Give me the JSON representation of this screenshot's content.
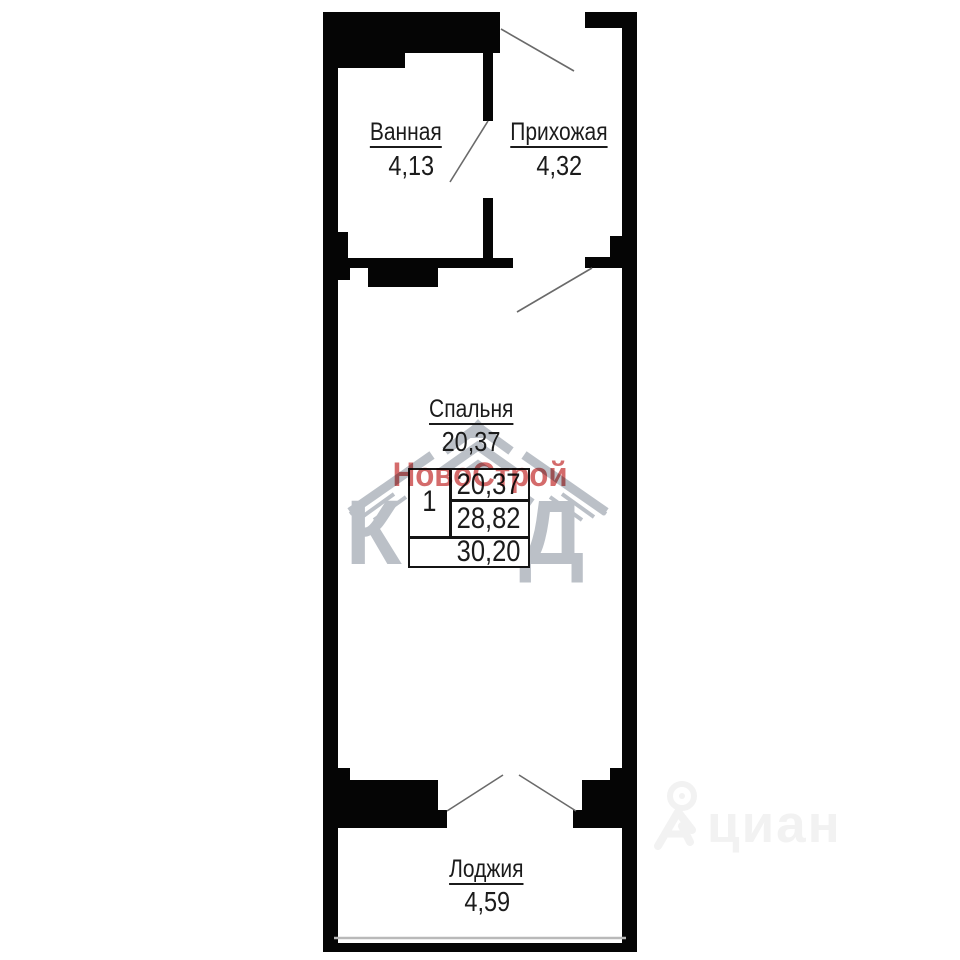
{
  "rooms": {
    "bathroom": {
      "name": "Ванная",
      "area": "4,13"
    },
    "hallway": {
      "name": "Прихожая",
      "area": "4,32"
    },
    "bedroom": {
      "name": "Спальня",
      "area": "20,37"
    },
    "loggia": {
      "name": "Лоджия",
      "area": "4,59"
    }
  },
  "area_table": {
    "rooms_count": "1",
    "living_area": "20,37",
    "area_without_loggia": "28,82",
    "total_area": "30,20"
  },
  "watermarks": {
    "developer_name": "НовоСтрой",
    "developer_abbr": "КВД",
    "listing_site": "циан"
  },
  "colors": {
    "wall_black": "#050505",
    "developer_red": "#cb4a4a",
    "developer_logo_gray": "#b4bac2",
    "site_watermark_gray": "#f2f2f2"
  }
}
